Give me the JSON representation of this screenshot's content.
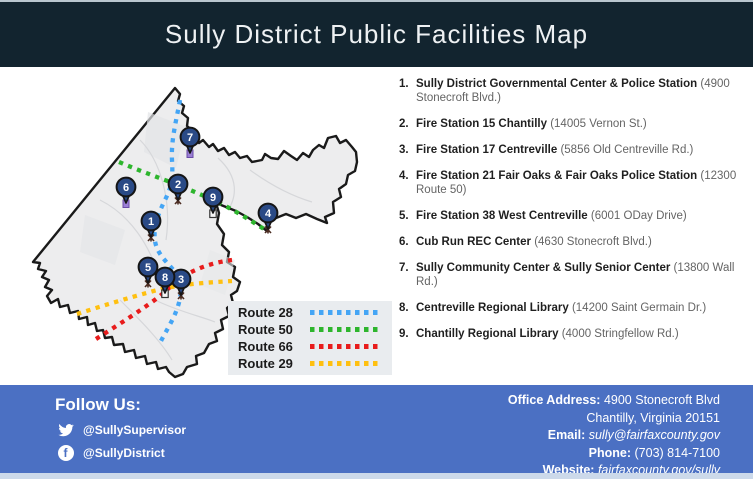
{
  "header": {
    "title": "Sully District Public Facilities Map"
  },
  "facilities": [
    {
      "num": "1.",
      "name": "Sully District Governmental Center & Police Station",
      "address": "(4900 Stonecroft Blvd.)"
    },
    {
      "num": "2.",
      "name": "Fire Station 15 Chantilly",
      "address": "(14005 Vernon St.)"
    },
    {
      "num": "3.",
      "name": "Fire Station 17 Centreville",
      "address": "(5856 Old Centreville Rd.)"
    },
    {
      "num": "4.",
      "name": "Fire Station 21 Fair Oaks & Fair Oaks Police Station",
      "address": "(12300 Route 50)"
    },
    {
      "num": "5.",
      "name": "Fire Station 38 West Centreville",
      "address": "(6001 ODay Drive)"
    },
    {
      "num": "6.",
      "name": "Cub Run REC Center",
      "address": "(4630 Stonecroft Blvd.)"
    },
    {
      "num": "7.",
      "name": "Sully Community Center & Sully Senior Center",
      "address": "(13800 Wall Rd.)"
    },
    {
      "num": "8.",
      "name": "Centreville Regional Library",
      "address": "(14200 Saint Germain Dr.)"
    },
    {
      "num": "9.",
      "name": "Chantilly Regional Library",
      "address": "(4000 Stringfellow Rd.)"
    }
  ],
  "legend": {
    "items": [
      {
        "label": "Route 28",
        "color": "#44a5f5"
      },
      {
        "label": "Route 50",
        "color": "#2db52d"
      },
      {
        "label": "Route 66",
        "color": "#e81c1c"
      },
      {
        "label": "Route 29",
        "color": "#ffc010"
      }
    ]
  },
  "map": {
    "pins": [
      {
        "number": "1",
        "x": 151,
        "y": 221,
        "icon": "fire-station-icon"
      },
      {
        "number": "2",
        "x": 178,
        "y": 184,
        "icon": "fire-station-icon"
      },
      {
        "number": "3",
        "x": 181,
        "y": 279,
        "icon": "fire-station-icon"
      },
      {
        "number": "4",
        "x": 268,
        "y": 213,
        "icon": "fire-station-icon"
      },
      {
        "number": "5",
        "x": 148,
        "y": 267,
        "icon": "fire-station-icon"
      },
      {
        "number": "6",
        "x": 126,
        "y": 187,
        "icon": "community-center-icon"
      },
      {
        "number": "7",
        "x": 190,
        "y": 137,
        "icon": "community-center-icon"
      },
      {
        "number": "8",
        "x": 165,
        "y": 277,
        "icon": "library-icon"
      },
      {
        "number": "9",
        "x": 213,
        "y": 197,
        "icon": "library-icon"
      }
    ]
  },
  "footer": {
    "follow_label": "Follow Us:",
    "socials": [
      {
        "icon": "twitter-icon",
        "handle": "@SullySupervisor"
      },
      {
        "icon": "facebook-icon",
        "handle": "@SullyDistrict"
      }
    ],
    "contact": [
      {
        "label": "Office Address:",
        "value": "4900 Stonecroft Blvd",
        "link": false
      },
      {
        "label": "",
        "value": "Chantilly, Virginia 20151",
        "link": false
      },
      {
        "label": "Email:",
        "value": "sully@fairfaxcounty.gov",
        "link": true
      },
      {
        "label": "Phone:",
        "value": "(703) 814-7100",
        "link": false
      },
      {
        "label": "Website:",
        "value": "fairfaxcounty.gov/sully",
        "link": true
      }
    ]
  },
  "colors": {
    "header_bg": "#12242f",
    "footer_bg": "#4b70c3",
    "pin_fill": "#2a4a86",
    "map_fill": "#ededee",
    "map_outline": "#1a1a1a"
  }
}
